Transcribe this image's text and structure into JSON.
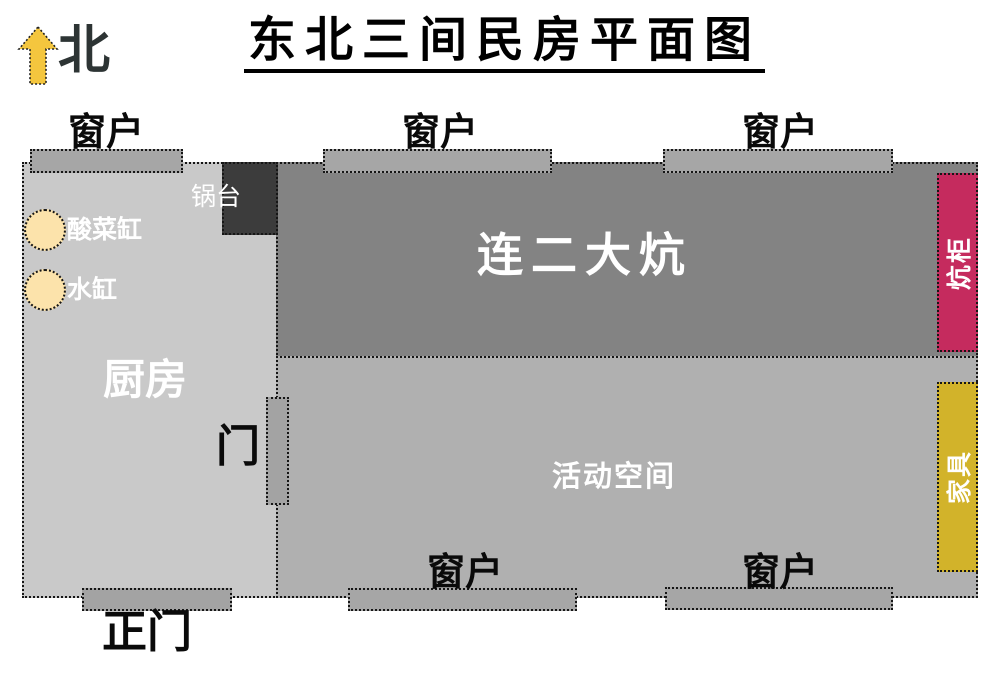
{
  "title": "东北三间民房平面图",
  "compass": {
    "label": "北"
  },
  "rooms": {
    "kitchen": {
      "label": "厨房"
    },
    "kang": {
      "label": "连二大炕"
    },
    "activity": {
      "label": "活动空间"
    }
  },
  "fixtures": {
    "stove": {
      "label": "锅台"
    },
    "pickle_vat": {
      "label": "酸菜缸"
    },
    "water_vat": {
      "label": "水缸"
    },
    "kang_cabinet": {
      "label": "炕柜"
    },
    "furniture": {
      "label": "家具"
    },
    "inner_door": {
      "label": "门"
    },
    "main_door": {
      "label": "正门"
    }
  },
  "window_label": "窗户",
  "colors": {
    "kitchen": "#c9c9c9",
    "kang": "#838383",
    "activity": "#b0b0b0",
    "window": "#a6a6a6",
    "door": "#a3a3a3",
    "stove": "#3c3c3c",
    "kang_cabinet": "#c52b5e",
    "furniture": "#d2b32a",
    "compass_arrow": "#f4c63e",
    "vat": "#fce3ab"
  }
}
